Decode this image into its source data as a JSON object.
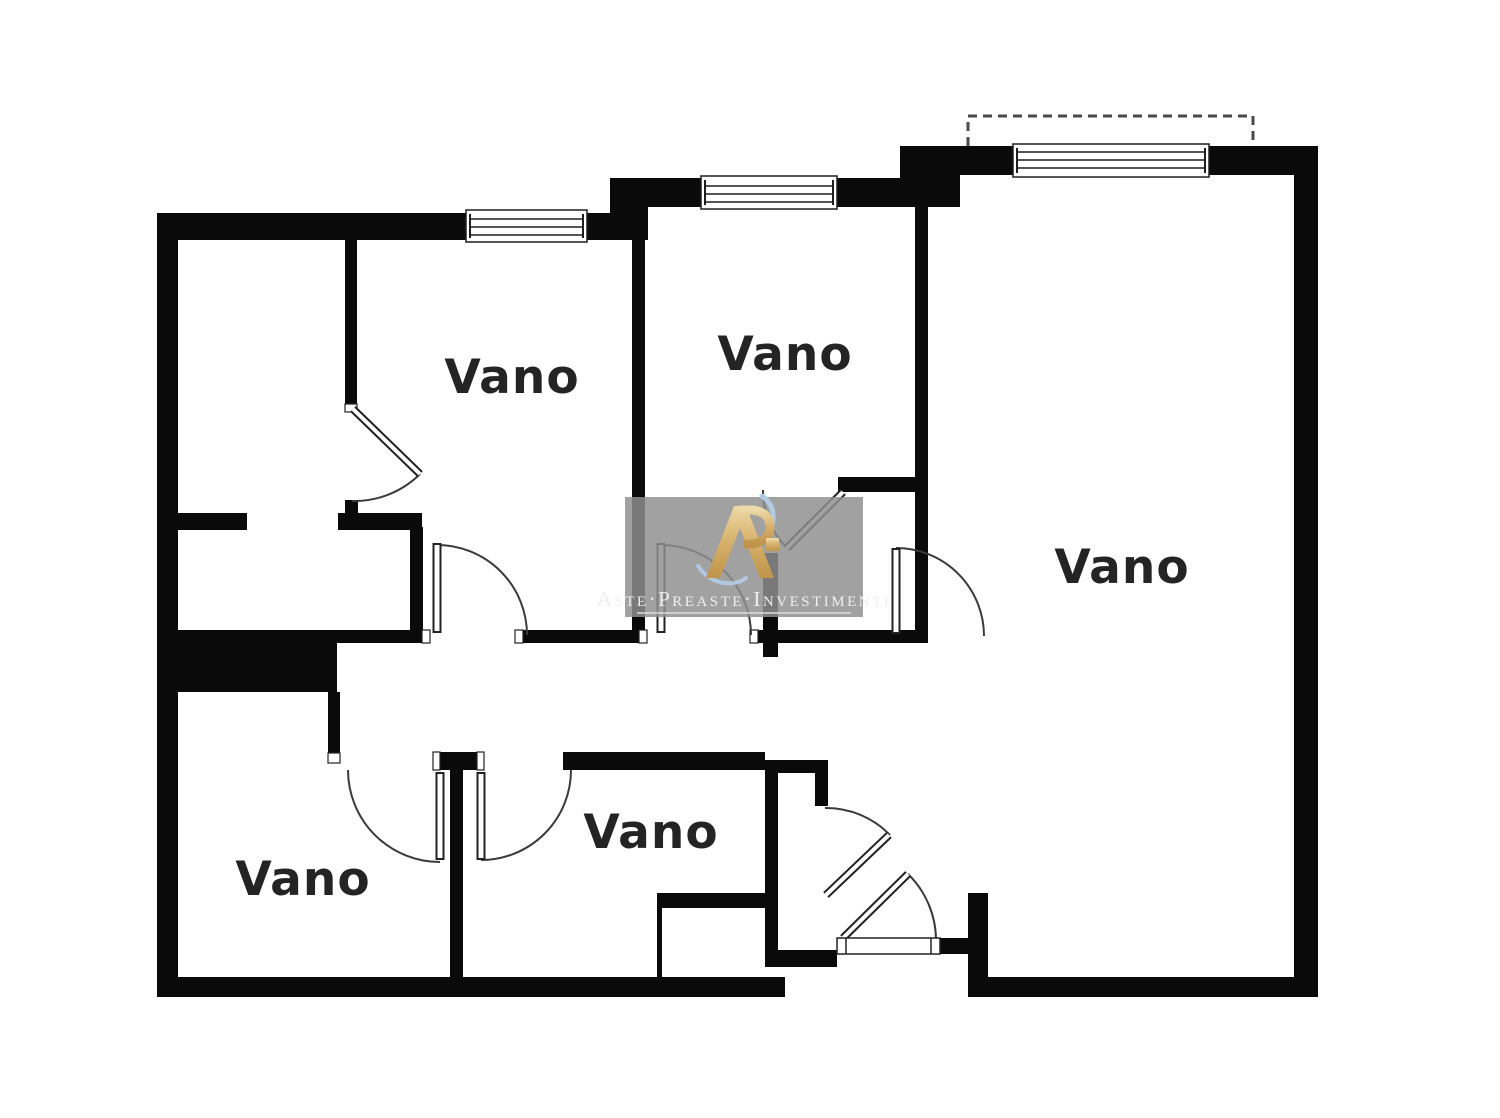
{
  "floorplan": {
    "rooms": [
      {
        "id": "room-top-center",
        "label": "Vano"
      },
      {
        "id": "room-top-middle",
        "label": "Vano"
      },
      {
        "id": "room-right-large",
        "label": "Vano"
      },
      {
        "id": "room-bottom-left",
        "label": "Vano"
      },
      {
        "id": "room-bottom-middle",
        "label": "Vano"
      }
    ],
    "colors": {
      "wall": "#0a0a0a",
      "floor": "#ffffff",
      "door_line": "#3a3a3a",
      "balcony_dash": "#4a4a4a"
    }
  },
  "watermark": {
    "brand_text": "Aste·Preaste·Investimenti",
    "monogram": "R",
    "colors": {
      "panel": "#8f8f8f",
      "gold": "#d0a75c",
      "blue": "#b3cce6",
      "text": "#efefef"
    }
  }
}
